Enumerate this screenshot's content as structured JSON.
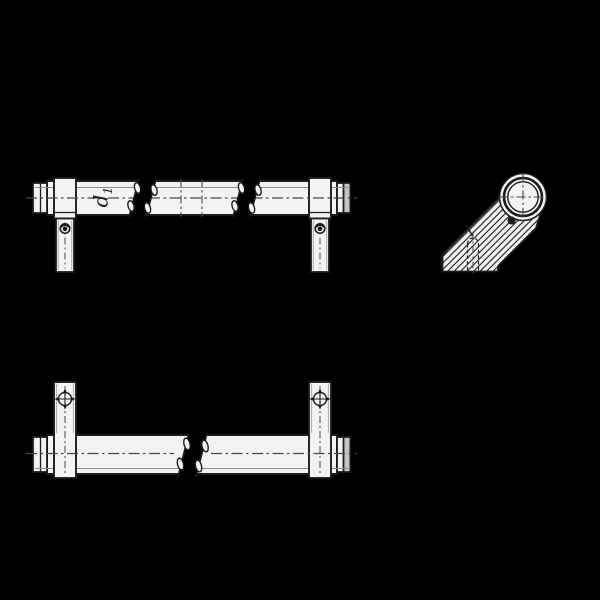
{
  "labels": {
    "tube_diameter_base": "d",
    "tube_diameter_sub": "1"
  },
  "colors": {
    "background": "#000000",
    "outline": "#1c1c1c",
    "part_fill": "#f3f3f3",
    "centerline": "#474747",
    "highlight": "#8c8c8c",
    "end_cap_shade": "#c4c4c4",
    "screw_face": "#e0e0e0",
    "screw_dark": "#111111"
  },
  "views": {
    "front": {
      "name": "front view of tubular handle",
      "break_symbols": 2
    },
    "side": {
      "name": "side view of tubular handle",
      "break_symbols": 0
    },
    "bottom": {
      "name": "bottom view of tubular handle",
      "break_symbols": 1
    }
  }
}
